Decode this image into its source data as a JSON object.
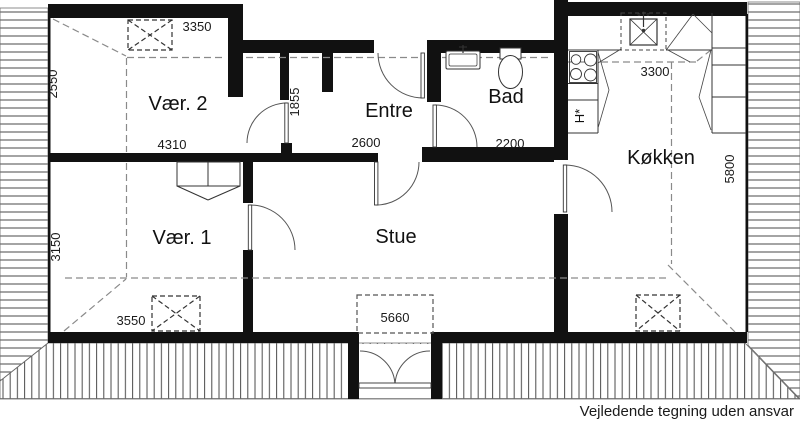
{
  "plan": {
    "rooms": {
      "vaer2": "Vær. 2",
      "vaer1": "Vær. 1",
      "entre": "Entre",
      "bad": "Bad",
      "stue": "Stue",
      "koekken": "Køkken"
    },
    "dimensions": {
      "vaer2_top": "3350",
      "vaer2_left": "2550",
      "vaer2_bottom": "4310",
      "entre_left": "1855",
      "entre_bottom": "2600",
      "bad_bottom": "2200",
      "koekken_top": "3300",
      "koekken_right": "5800",
      "vaer1_left": "3150",
      "vaer1_bottom": "3550",
      "stue_bottom": "5660"
    },
    "fixtures": {
      "fridge_label": "H*"
    },
    "footer_note": "Vejledende tegning uden ansvar",
    "colors": {
      "wall": "#111111",
      "hatch": "#4a4a4a",
      "dashed": "#8a8a8a",
      "line": "#333333"
    }
  }
}
